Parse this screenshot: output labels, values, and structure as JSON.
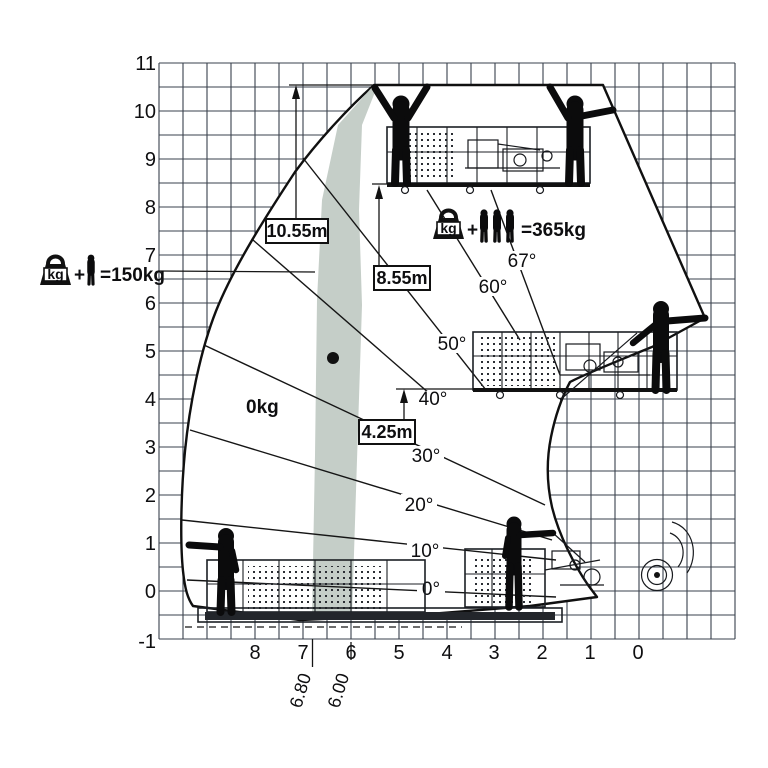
{
  "diagram": {
    "y_axis": [
      "11",
      "10",
      "9",
      "8",
      "7",
      "6",
      "5",
      "4",
      "3",
      "2",
      "1",
      "0",
      "-1"
    ],
    "x_axis": [
      "8",
      "7",
      "6",
      "5",
      "4",
      "3",
      "2",
      "1",
      "0"
    ],
    "angle_labels": [
      "0°",
      "10°",
      "20°",
      "30°",
      "40°",
      "50°",
      "60°",
      "67°"
    ],
    "height_marks": {
      "top": "10.55m",
      "mid": "8.55m",
      "low": "4.25m"
    },
    "outreach_marks": {
      "outer": "6.80",
      "inner": "6.00"
    },
    "zone_label": "0kg",
    "load_min": {
      "icon": "kg",
      "plus": "+",
      "formula": "=150kg"
    },
    "load_max": {
      "icon": "kg",
      "plus": "+",
      "formula": "=365kg"
    }
  },
  "chart_data": {
    "type": "working-range-diagram",
    "x_axis": {
      "label": "outreach (m)",
      "range": [
        0,
        8
      ],
      "direction": "right-to-left",
      "grid_step_m": 0.5
    },
    "y_axis": {
      "label": "height (m)",
      "range": [
        -1,
        11
      ],
      "grid_step_m": 0.5
    },
    "boom_angle_lines_deg": [
      0,
      10,
      20,
      30,
      40,
      50,
      60,
      67
    ],
    "platform_floor_heights_m": [
      10.55,
      8.55,
      4.25
    ],
    "outreach_band_m": [
      6.8,
      6.0
    ],
    "capacities_kg": {
      "outer_zone": 150,
      "inner_zone": 365,
      "empty_zone_label": 0
    },
    "band_color": "#c5cec8"
  }
}
